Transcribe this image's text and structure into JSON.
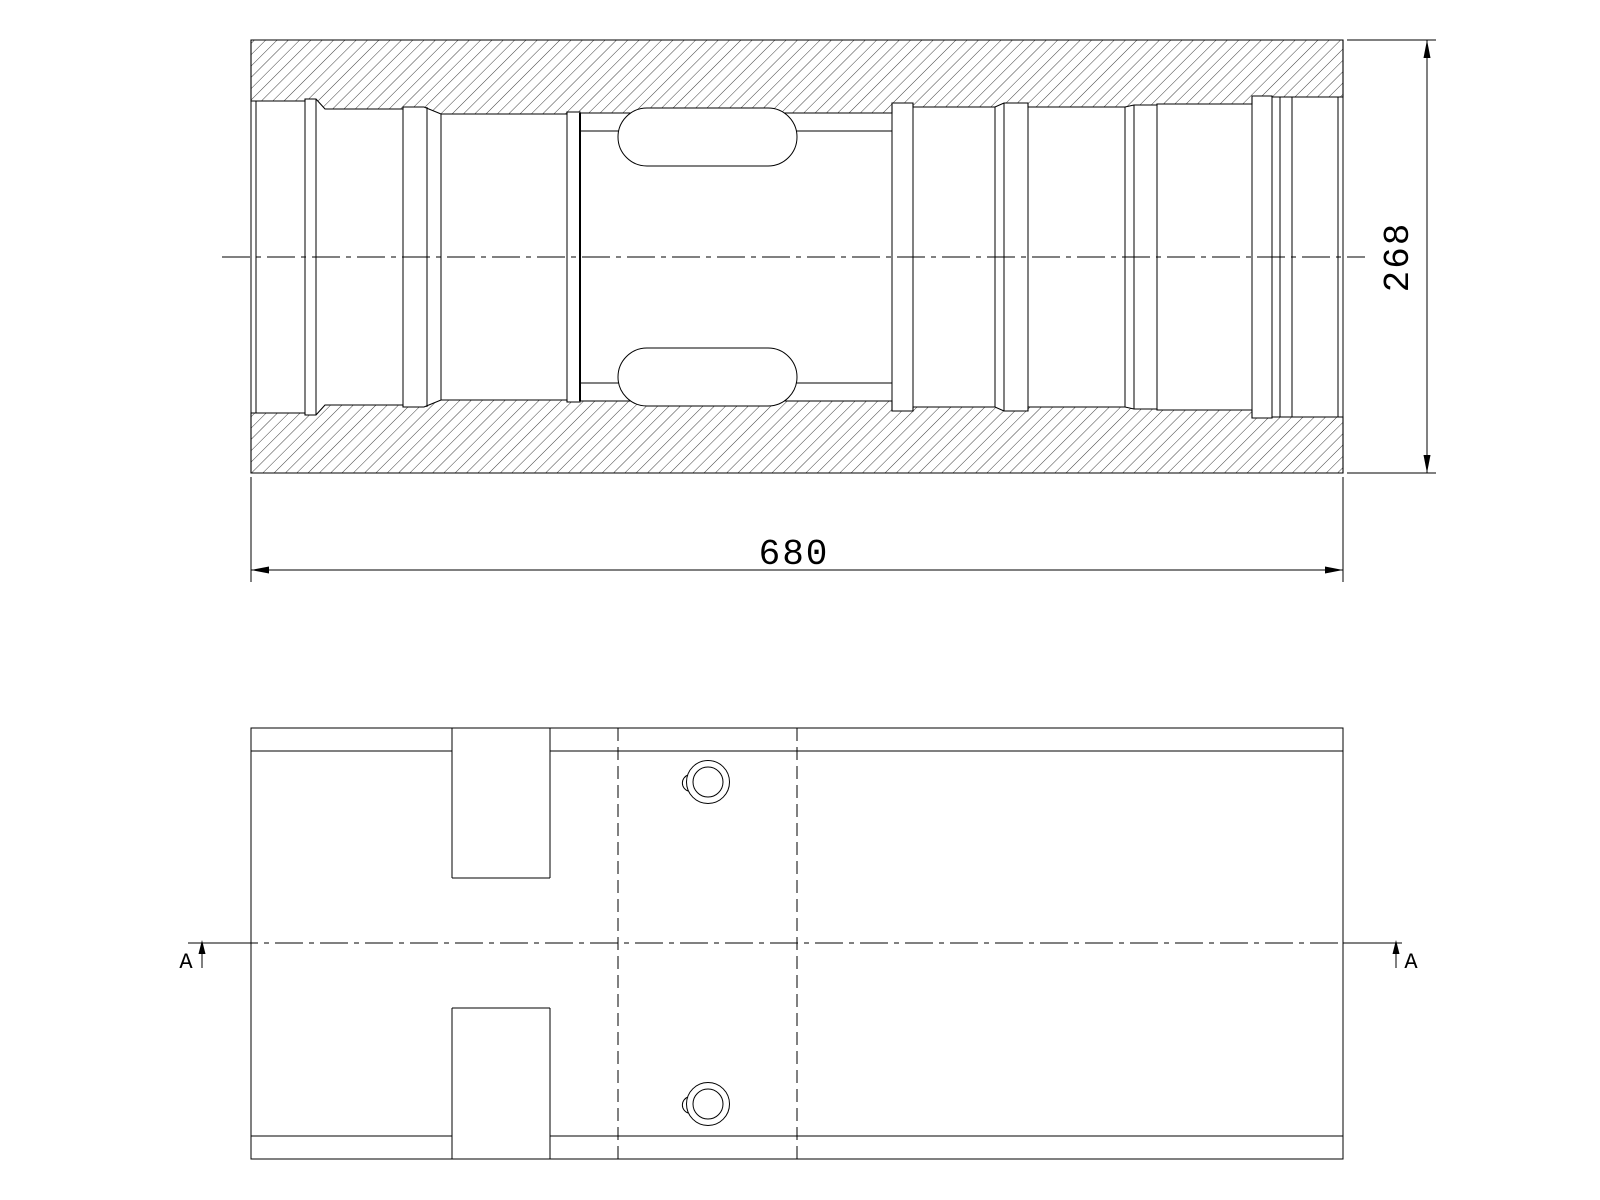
{
  "page": {
    "background_color": "#ffffff",
    "line_color": "#000000"
  },
  "section_view": {
    "description": "longitudinal-section-view-hatched",
    "length_dimension_label": "680",
    "height_dimension_label": "268"
  },
  "plan_view": {
    "description": "outside-plan-view-with-section-line",
    "section_arrow_left_label": "A",
    "section_arrow_right_label": "A"
  }
}
